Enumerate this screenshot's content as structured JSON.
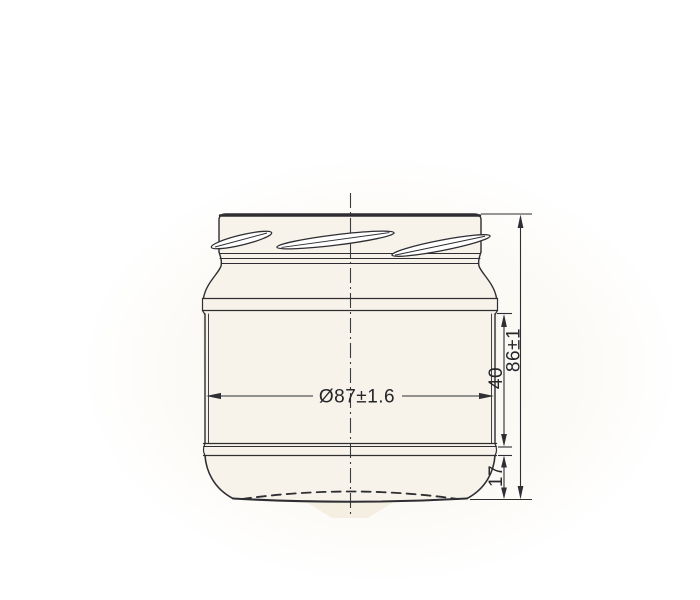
{
  "drawing": {
    "kind": "technical drawing",
    "subject": "glass jar with twist-off finish, front elevation",
    "annotations": {
      "diameter": "Ø87±1.6",
      "height_total": "86±1",
      "height_body": "40",
      "height_base": "17"
    },
    "colors": {
      "line": "#2e2e33",
      "paper": "#ffffff",
      "scan_tint": "#f3edde",
      "jar_fill": "#f7f3ea"
    }
  }
}
